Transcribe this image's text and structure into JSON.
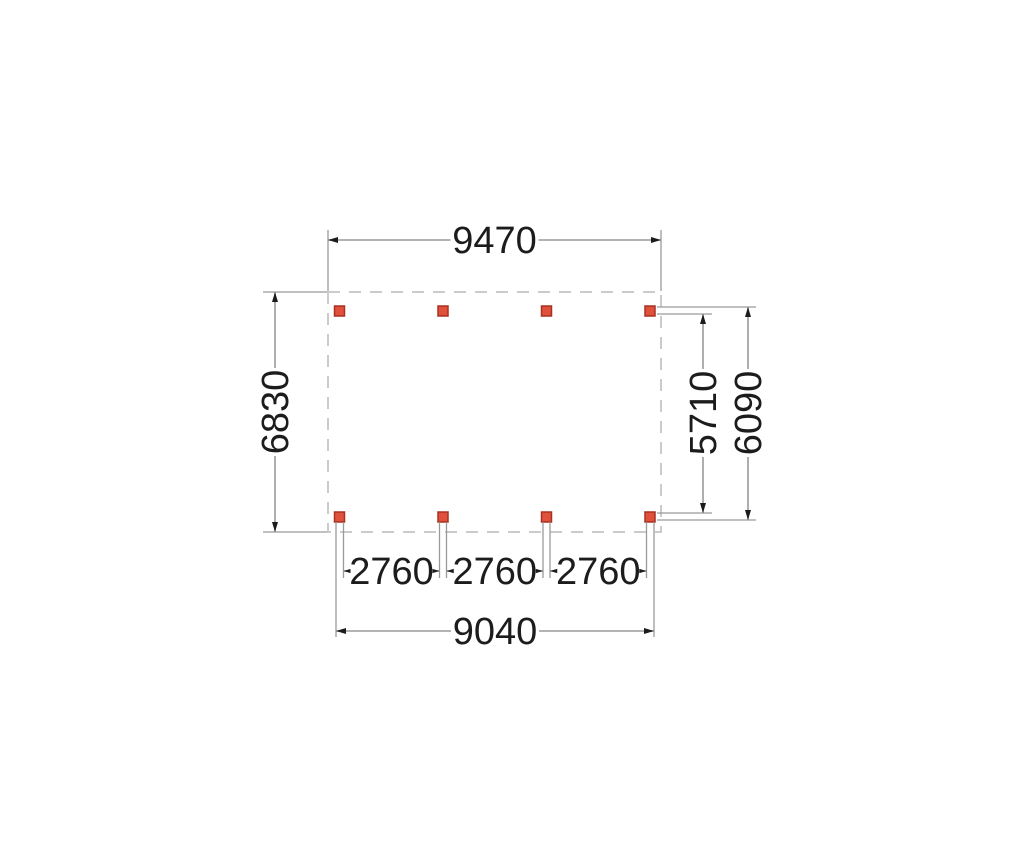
{
  "colors": {
    "background": "#ffffff",
    "dimension-line": "#9a9a9a",
    "outline-dash": "#cbcbcb",
    "arrow": "#1c1c1c",
    "label-text": "#1c1c1c",
    "post-fill": "#e0513b",
    "post-stroke": "#a93122"
  },
  "plan": {
    "outline": "dashed roof outline",
    "posts": {
      "rows": 2,
      "columns": 4,
      "count": 8
    },
    "dimensions": {
      "top_width": "9470",
      "left_depth": "6830",
      "right_inner_depth": "5710",
      "right_outer_depth": "6090",
      "bottom_spans": [
        "2760",
        "2760",
        "2760"
      ],
      "bottom_total_width": "9040"
    }
  }
}
